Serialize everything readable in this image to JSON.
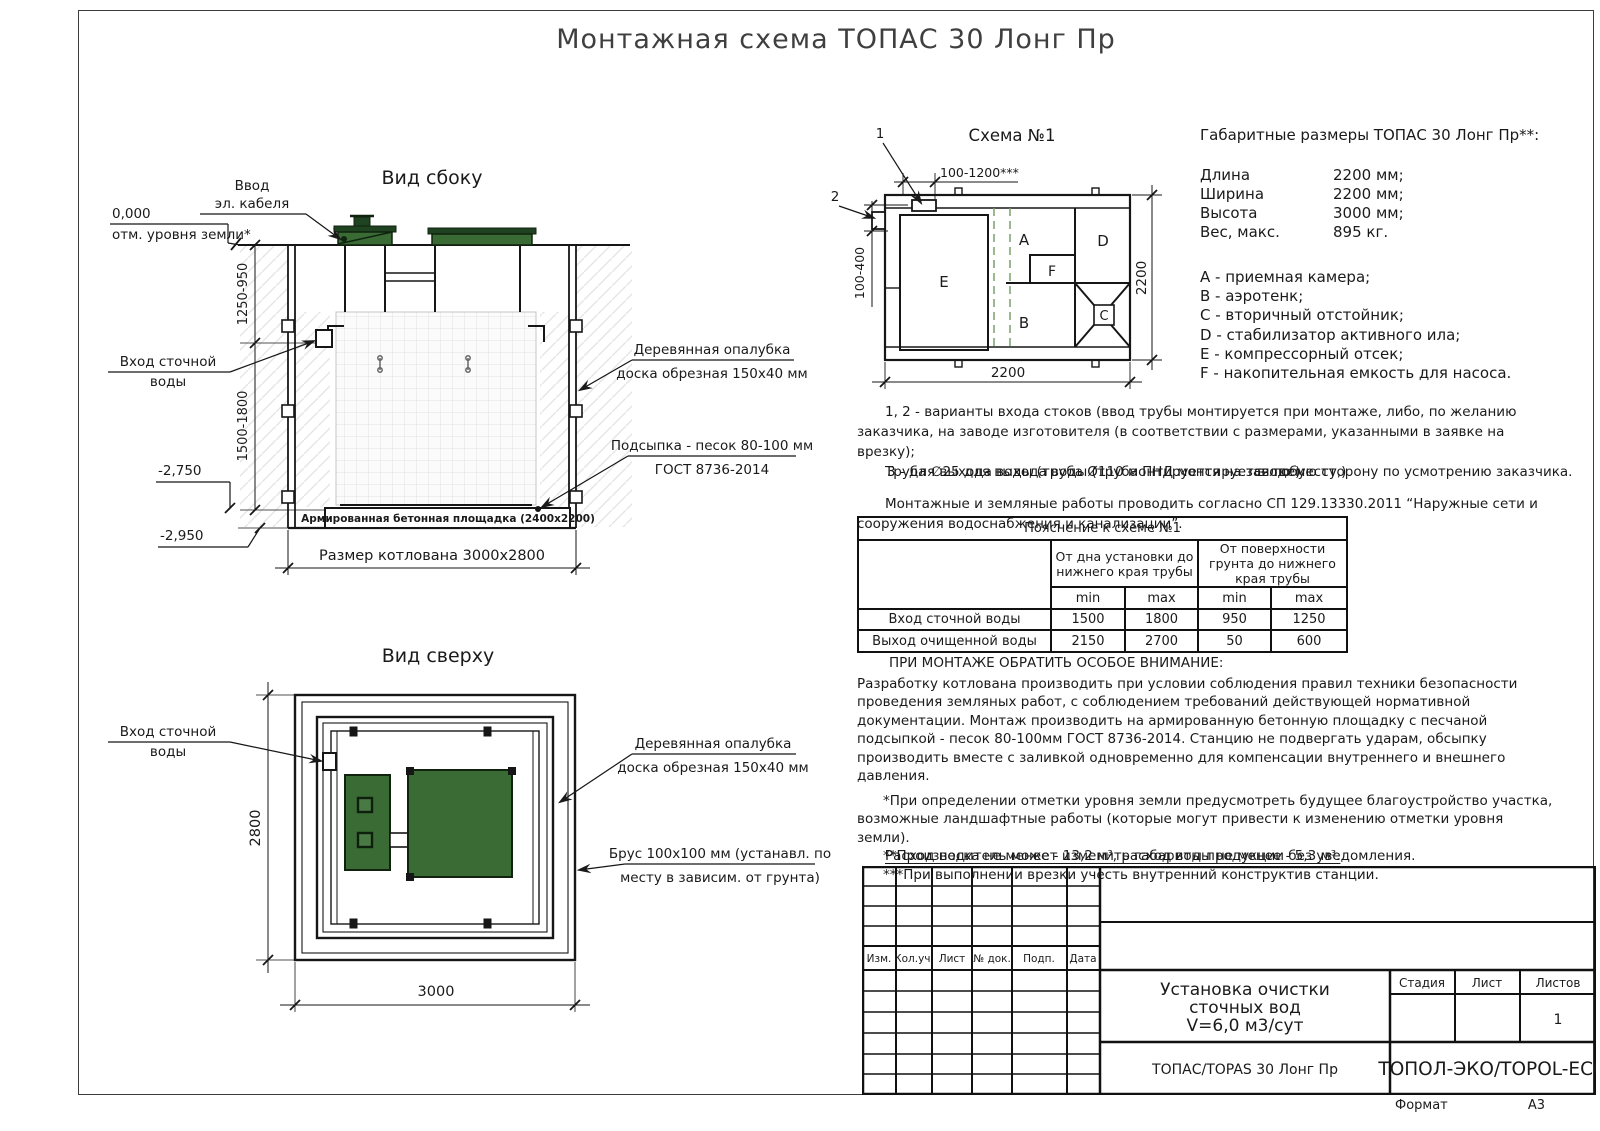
{
  "page": {
    "title": "Монтажная схема ТОПАС 30 Лонг Пр",
    "format_label": "Формат",
    "format_value": "А3"
  },
  "side_view": {
    "title": "Вид сбоку",
    "cable_entry_1": "Ввод",
    "cable_entry_2": "эл. кабеля",
    "zero_mark": "0,000",
    "ground_label": "отм. уровня земли*",
    "dim_upper": "1250-950",
    "dim_lower": "1500-1800",
    "inlet_1": "Вход сточной",
    "inlet_2": "воды",
    "level_pad": "-2,750",
    "level_bottom": "-2,950",
    "pad_label": "Армированная бетонная площадка (2400х2200)",
    "pit_dim": "Размер котлована 3000х2800",
    "formwork_1": "Деревянная опалубка",
    "formwork_2": "доска обрезная 150х40 мм",
    "bedding_1": "Подсыпка - песок 80-100 мм",
    "bedding_2": "ГОСТ 8736-2014"
  },
  "top_view": {
    "title": "Вид сверху",
    "inlet_1": "Вход сточной",
    "inlet_2": "воды",
    "dim_height": "2800",
    "dim_width": "3000",
    "formwork_1": "Деревянная опалубка",
    "formwork_2": "доска обрезная 150х40 мм",
    "beam_1": "Брус 100х100 мм (устанавл. по",
    "beam_2": "месту в зависим. от грунта)"
  },
  "schema": {
    "title": "Схема №1",
    "callout_1": "1",
    "callout_2": "2",
    "dim_top": "100-1200***",
    "dim_left": "100-400",
    "dim_right": "2200",
    "dim_bottom": "2200",
    "comp_a": "A",
    "comp_b": "B",
    "comp_c": "C",
    "comp_d": "D",
    "comp_e": "E",
    "comp_f": "F"
  },
  "specs": {
    "heading": "Габаритные размеры ТОПАС 30 Лонг Пр**:",
    "rows": [
      {
        "label": "Длина",
        "value": "2200 мм;"
      },
      {
        "label": "Ширина",
        "value": "2200 мм;"
      },
      {
        "label": "Высота",
        "value": "3000 мм;"
      },
      {
        "label": "Вес, макс.",
        "value": "895 кг."
      }
    ],
    "legend": [
      "A - приемная камера;",
      "B - аэротенк;",
      "C - вторичный отстойник;",
      "D - стабилизатор активного ила;",
      "E - компрессорный отсек;",
      "F - накопительная емкость для насоса."
    ]
  },
  "notes": {
    "variants": "1, 2 - варианты входа  стоков (ввод трубы монтируется при монтаже, либо, по желанию заказчика, на заводе изготовителя (в соответствии с размерами, указанными в заявке на врезку);",
    "overlap_a": "Труба ∅25 для выхода воды (труба ПНД монтируется по месту,)",
    "overlap_b": "3 - для выхода воды (труба Ø110 монтируется на заводе)",
    "overlap_tail": "в любую сторону по усмотрению заказчика.",
    "works": "Монтажные и земляные работы проводить согласно СП 129.13330.2011 “Наружные сети и сооружения водоснабжения и канализации”."
  },
  "ptable": {
    "title": "Пояснение к схеме №1",
    "group_1": "От дна установки до нижнего края трубы",
    "group_2": "От поверхности грунта до нижнего края трубы",
    "min_label": "min",
    "max_label": "max",
    "rows": [
      {
        "label": "Вход сточной воды",
        "v1": "1500",
        "v2": "1800",
        "v3": "950",
        "v4": "1250"
      },
      {
        "label": "Выход очищенной воды",
        "v1": "2150",
        "v2": "2700",
        "v3": "50",
        "v4": "600"
      }
    ]
  },
  "warning": {
    "heading": "ПРИ МОНТАЖЕ ОБРАТИТЬ ОСОБОЕ ВНИМАНИЕ:",
    "body": "Разработку котлована производить при условии соблюдения правил техники безопасности проведения земляных работ, с соблюдением требований действующей нормативной документации.  Монтаж производить на армированную бетонную площадку с песчаной подсыпкой - песок 80-100мм ГОСТ 8736-2014. Станцию не подвергать ударам, обсыпку производить вместе с заливкой одновременно для компенсации внутреннего и внешнего давления.",
    "footnote_1": "*При определении отметки уровня земли предусмотреть будущее благоустройство участка, возможные ландшафтные работы (которые могут привести к изменению отметки уровня земли).",
    "footnote_2": "**Производитель может изменить габариты продукции без уведомления.",
    "footnote_3": "***При выполнении врезки учесть внутренний конструктив станции.",
    "consumption": "Расход песка не менее - 13,2 м³, расход воды не менее - 5,3 м³."
  },
  "title_block": {
    "rev_headers": [
      "Изм.",
      "Кол.уч.",
      "Лист",
      "№ док.",
      "Подп.",
      "Дата"
    ],
    "project_1": "Установка очистки",
    "project_2": "сточных вод",
    "project_3": "V=6,0 м3/сут",
    "stage_label": "Стадия",
    "sheet_label": "Лист",
    "sheets_label": "Листов",
    "sheets_value": "1",
    "product": "ТОПАС/TOPAS 30 Лонг Пр",
    "company": "ТОПОЛ-ЭКО/TOPOL-ECO"
  },
  "colors": {
    "line": "#1a1a1a",
    "lid_green": "#3a6b35",
    "lid_dark_green": "#1f4220",
    "dash_green": "#7aa06c"
  }
}
